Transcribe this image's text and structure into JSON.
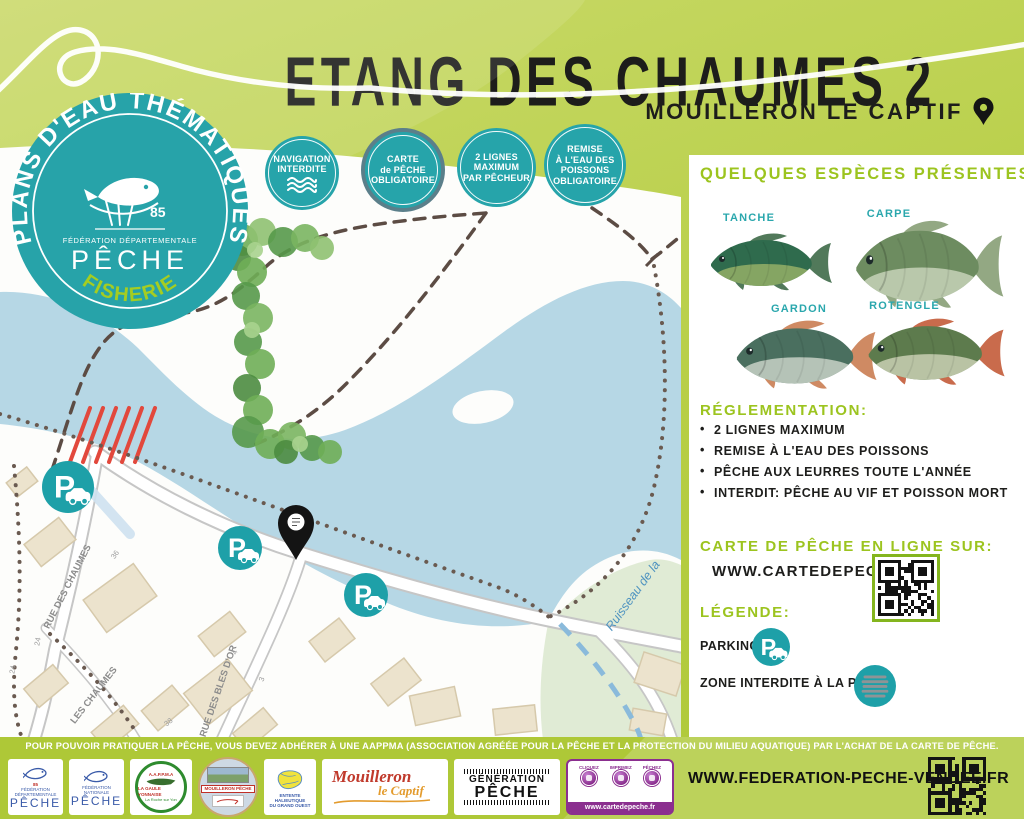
{
  "header": {
    "title": "ETANG DES CHAUMES 2",
    "subtitle": "MOUILLERON LE CAPTIF"
  },
  "badge": {
    "arc_text": "PLANS D'EAU THÉMATIQUES",
    "dept": "85",
    "org_line": "FÉDÉRATION DÉPARTEMENTALE",
    "org": "PÊCHE",
    "tagline": "FISHERIE"
  },
  "info_badges": [
    {
      "lines": [
        "NAVIGATION",
        "INTERDITE"
      ]
    },
    {
      "lines": [
        "CARTE",
        "de PÊCHE",
        "OBLIGATOIRE"
      ]
    },
    {
      "lines": [
        "2 LIGNES",
        "MAXIMUM",
        "PAR PÊCHEUR"
      ]
    },
    {
      "lines": [
        "REMISE",
        "À L'EAU DES",
        "POISSONS",
        "OBLIGATOIRE"
      ]
    }
  ],
  "map": {
    "streets": [
      "RUE DES CHAUMES",
      "LES CHAUMES",
      "RUE DES BLES D'OR"
    ],
    "stream_label": "Ruisseau de la",
    "house_numbers": [
      "36",
      "24",
      "24",
      "4",
      "3",
      "38"
    ]
  },
  "species": {
    "heading": "QUELQUES ESPÈCES PRÉSENTES:",
    "items": [
      {
        "name": "TANCHE"
      },
      {
        "name": "CARPE"
      },
      {
        "name": "GARDON"
      },
      {
        "name": "ROTENGLE"
      }
    ]
  },
  "regulation": {
    "heading": "RÉGLEMENTATION:",
    "rules": [
      "2 LIGNES MAXIMUM",
      "REMISE À L'EAU DES POISSONS",
      "PÊCHE AUX LEURRES TOUTE L'ANNÉE",
      "INTERDIT: PÊCHE AU VIF ET POISSON MORT"
    ]
  },
  "card_online": {
    "heading": "CARTE DE PÊCHE EN LIGNE SUR:",
    "url": "WWW.CARTEDEPECHE.FR"
  },
  "legend": {
    "heading": "LÉGENDE:",
    "parking_label": "PARKING",
    "zone_label": "ZONE INTERDITE À LA PÊCHE"
  },
  "footer": {
    "notice": "POUR POUVOIR PRATIQUER LA PÊCHE, VOUS DEVEZ ADHÉRER À UNE AAPPMA (ASSOCIATION AGRÉÉE POUR LA PÊCHE ET LA PROTECTION DU MILIEU AQUATIQUE) PAR L'ACHAT DE LA CARTE DE PÊCHE.",
    "website": "WWW.FEDERATION-PECHE-VENDEE.FR",
    "logos": [
      {
        "id": "fede-dep-85",
        "line1": "FÉDÉRATION DÉPARTEMENTALE",
        "line2": "PÊCHE",
        "num": "85"
      },
      {
        "id": "fede-nat",
        "line1": "FÉDÉRATION NATIONALE",
        "line2": "PÊCHE"
      },
      {
        "id": "aappma",
        "line1": "A.A.P.P.M.A",
        "line2": "LA GAULE YONNAISE",
        "line3": "La Roche sur Yon"
      },
      {
        "id": "mouilleron-peche",
        "line1": "MOUILLERON PÊCHE"
      },
      {
        "id": "entente",
        "line1": "ENTENTE HALIEUTIQUE",
        "line2": "DU GRAND OUEST"
      },
      {
        "id": "mouilleron-le-captif",
        "line1": "Mouilleron",
        "line2": "le Captif"
      },
      {
        "id": "generation-peche",
        "line1": "GÉNÉRATION",
        "line2": "PÊCHE"
      },
      {
        "id": "cartedepeche",
        "line1": "CLIQUEZ",
        "line2": "IMPRIMEZ",
        "line3": "PÊCHEZ",
        "line4": "www.cartedepeche.fr"
      }
    ]
  },
  "colors": {
    "green_bg": "#b4cc40",
    "green_text": "#9cc41f",
    "teal": "#26a4aa",
    "water": "#b6d7e5",
    "no_fish_red": "#e2483c"
  }
}
